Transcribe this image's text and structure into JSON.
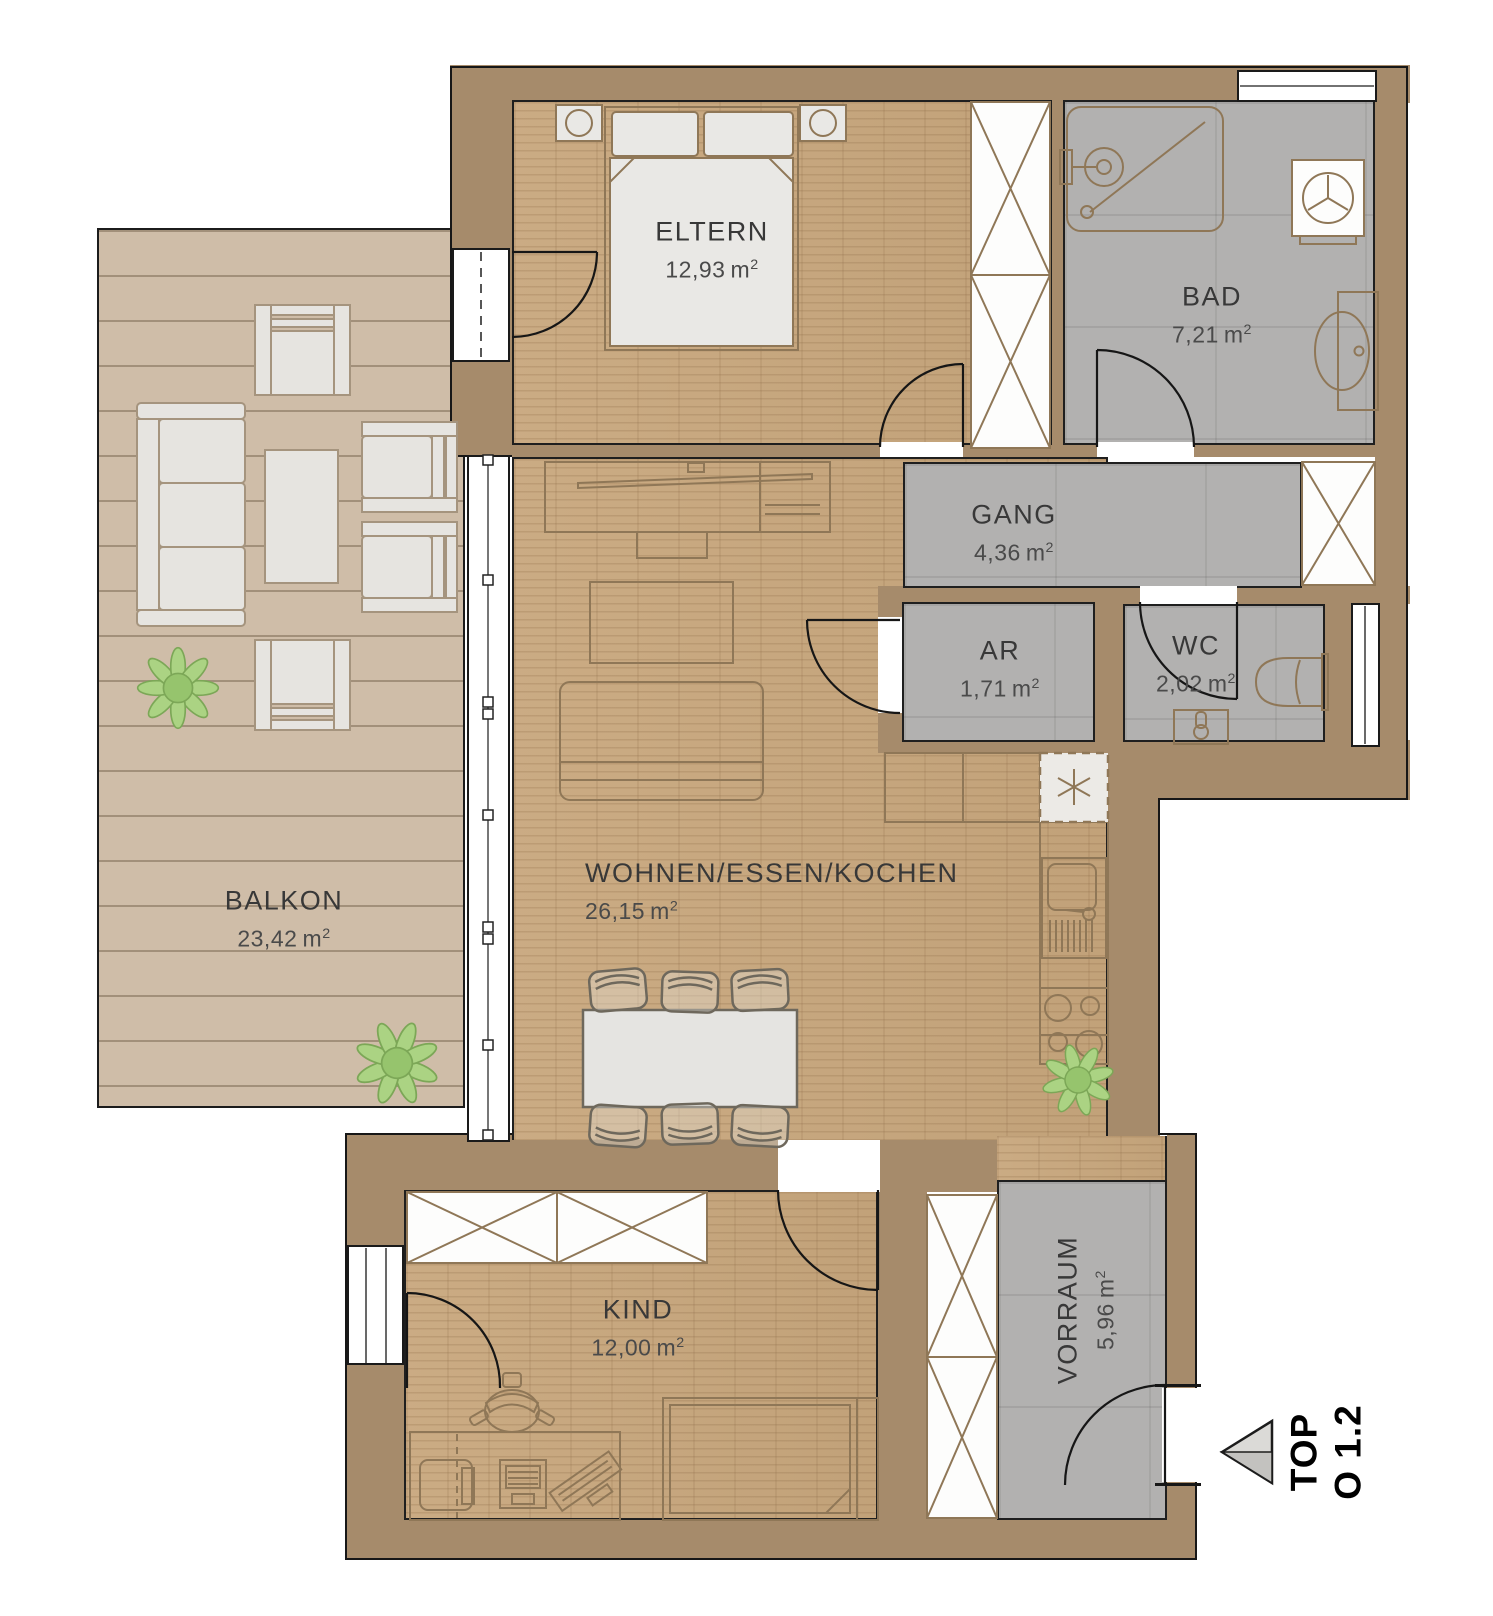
{
  "rooms": {
    "eltern": {
      "name": "ELTERN",
      "area": "12,93"
    },
    "bad": {
      "name": "BAD",
      "area": "7,21"
    },
    "gang": {
      "name": "GANG",
      "area": "4,36"
    },
    "ar": {
      "name": "AR",
      "area": "1,71"
    },
    "wc": {
      "name": "WC",
      "area": "2,02"
    },
    "balkon": {
      "name": "BALKON",
      "area": "23,42"
    },
    "wohnen": {
      "name": "WOHNEN/ESSEN/KOCHEN",
      "area": "26,15"
    },
    "kind": {
      "name": "KIND",
      "area": "12,00"
    },
    "vorraum": {
      "name": "VORRAUM",
      "area": "5,96"
    }
  },
  "units": {
    "m": "m",
    "sup": "2"
  },
  "unit_label": {
    "line1": "TOP",
    "line2": "O 1.2"
  },
  "colors": {
    "wall": "#a68b6b",
    "wood": "#c8a77d",
    "tile": "#b2b1b0",
    "deck": "#cfbda8",
    "outline": "#8f7757",
    "green": "#abd383"
  }
}
